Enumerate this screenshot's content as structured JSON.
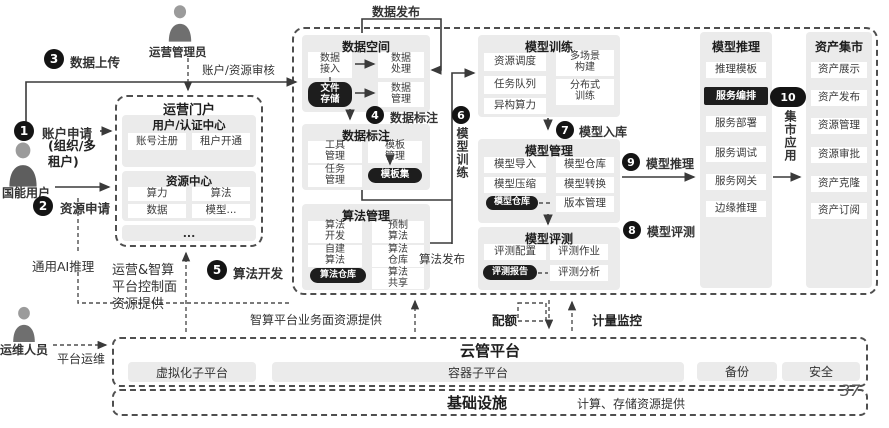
{
  "page_number": "37",
  "actors": {
    "admin": "运营管理员",
    "user": "国能用户",
    "ops": "运维人员"
  },
  "steps": {
    "n1": "1",
    "n2": "2",
    "n3": "3",
    "n4": "4",
    "n5": "5",
    "n6": "6",
    "n7": "7",
    "n8": "8",
    "n9": "9",
    "n10": "10",
    "s1": "账户申请",
    "s1_sub": "(组织/多\n租户)",
    "s2": "资源申请",
    "s3": "数据上传",
    "s4": "数据标注",
    "s5": "算法开发",
    "s6": "模型训练",
    "s7": "模型入库",
    "s8": "模型评测",
    "s9": "模型推理",
    "s10": "集市应用"
  },
  "labels": {
    "review": "账户/资源审核",
    "data_publish": "数据发布",
    "algo_publish": "算法发布",
    "general_ai": "通用AI推理",
    "control_plane": "运营&智算\n平台控制面\n资源提供",
    "business_plane": "智算平台业务面资源提供",
    "quota": "配额",
    "metering": "计量监控",
    "platform_ops": "平台运维"
  },
  "portal": {
    "title": "运营门户",
    "auth": {
      "title": "用户/认证中心",
      "items": [
        "账号注册",
        "租户开通"
      ]
    },
    "resource": {
      "title": "资源中心",
      "items": [
        "算力",
        "算法",
        "数据",
        "模型..."
      ]
    },
    "more": "..."
  },
  "dataspace": {
    "title": "数据空间",
    "access": "数据\n接入",
    "process": "数据\n处理",
    "file_store": "文件\n存储",
    "manage": "数据\n管理"
  },
  "annotate": {
    "title": "数据标注",
    "tool": "工具\n管理",
    "template": "模板\n管理",
    "task": "任务\n管理",
    "template_set": "模板集"
  },
  "algo": {
    "title": "算法管理",
    "dev": "算法\n开发",
    "prebuilt": "预制\n算法",
    "selfbuilt": "自建\n算法",
    "repo": "算法\n仓库",
    "repo_store": "算法仓库",
    "share": "算法\n共享"
  },
  "train": {
    "title": "模型训练",
    "schedule": "资源调度",
    "multi_scene": "多场景\n构建",
    "queue": "任务队列",
    "distributed": "分布式\n训练",
    "hetero": "异构算力"
  },
  "model_mgmt": {
    "title": "模型管理",
    "import": "模型导入",
    "repo": "模型仓库",
    "compress": "模型压缩",
    "convert": "模型转换",
    "repo_store": "模型仓库",
    "version": "版本管理"
  },
  "model_eval": {
    "title": "模型评测",
    "config": "评测配置",
    "job": "评测作业",
    "report": "评测报告",
    "analysis": "评测分析"
  },
  "inference": {
    "title": "模型推理",
    "items": [
      "推理模板",
      "服务编排",
      "服务部署",
      "服务调试",
      "服务网关",
      "边缘推理"
    ]
  },
  "market": {
    "title": "资产集市",
    "items": [
      "资产展示",
      "资产发布",
      "资源管理",
      "资源审批",
      "资产克隆",
      "资产订阅"
    ]
  },
  "cloud": {
    "title": "云管平台",
    "virtualization": "虚拟化子平台",
    "container": "容器子平台",
    "backup": "备份",
    "security": "安全"
  },
  "infra": {
    "title": "基础设施",
    "note": "计算、存储资源提供"
  },
  "colors": {
    "dark_pill": "#1d1d1d",
    "panel": "#ebebeb",
    "line": "#3a3a3a"
  }
}
